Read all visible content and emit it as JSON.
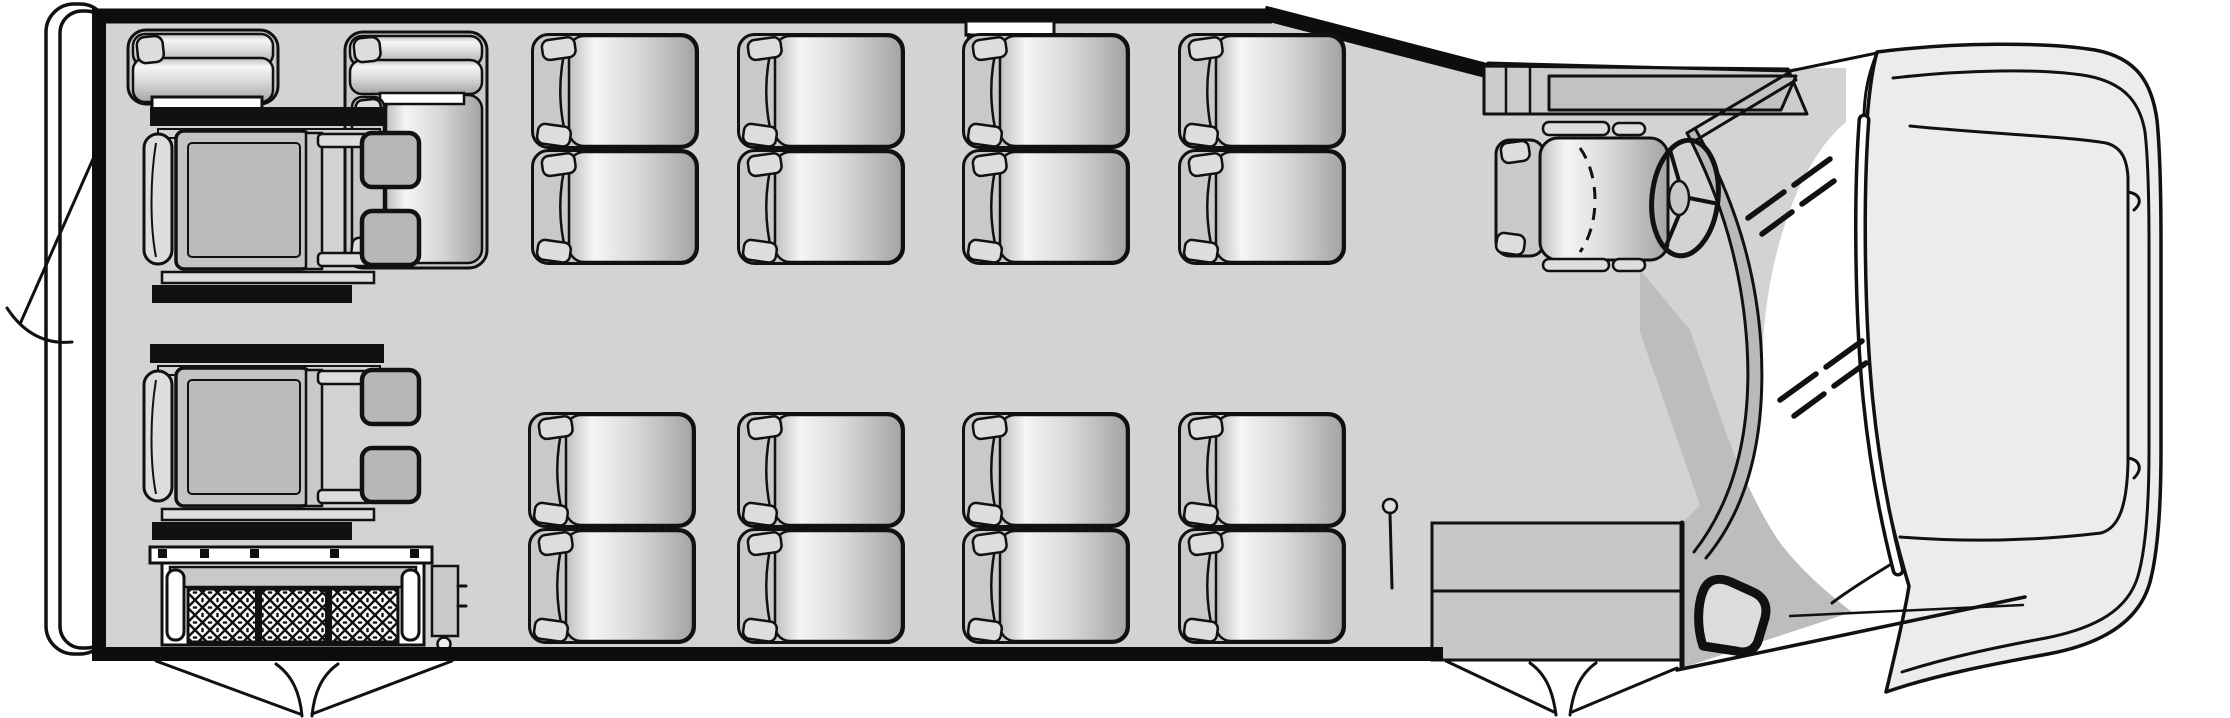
{
  "diagram": {
    "kind": "vehicle-floor-plan",
    "subject": "wheelchair-accessible-shuttle-bus-top-view",
    "vehicle_front_side": "right",
    "vehicle_rear_side": "left"
  },
  "counts": {
    "forward_facing_double_seat_blocks": 8,
    "forward_facing_passenger_seats": 16,
    "rear_flip_bench_seats": 2,
    "wheelchair_positions": 2,
    "wheelchair_securement_tracks": 4,
    "driver_seats": 1,
    "entry_steps": 2,
    "door_swing_marks": 3,
    "windshield_glass_marks": 2,
    "wheelchair_lifts": 1
  },
  "colors": {
    "background": "#ffffff",
    "floor": "#d3d3d3",
    "outline": "#111111",
    "wall": "#0d0d0d",
    "seat_frame": "#c9c9c9",
    "seat_cushion_light": "#f5f5f5",
    "seat_cushion_mid": "#d8d8d8",
    "seat_cushion_dark": "#a4a4a4",
    "strap": "#dddddd",
    "wheelchair_seat": "#c4c4c4",
    "wheelchair_seat_inner": "#bcbcbc",
    "footrest": "#b7b7b7",
    "steps": "#c7c7c7",
    "entry_panel": "#bdbdbd",
    "pillar": "#b9b9b9",
    "hood": "#ececec",
    "dash": "#cccccc",
    "dash_inner": "#c2c2c2",
    "lift_band": "#c9c9c9",
    "door_window": "#dcdcdc"
  },
  "layout": {
    "canvas": {
      "width": 2230,
      "height": 718
    },
    "seat_block_size": {
      "width": 168,
      "height": 232
    },
    "seat_blocks": [
      {
        "id": "curb-row-1",
        "x": 531,
        "y": 33
      },
      {
        "id": "curb-row-2",
        "x": 737,
        "y": 33
      },
      {
        "id": "curb-row-3",
        "x": 962,
        "y": 33
      },
      {
        "id": "curb-row-4",
        "x": 1178,
        "y": 33
      },
      {
        "id": "road-row-1",
        "x": 528,
        "y": 412
      },
      {
        "id": "road-row-2",
        "x": 737,
        "y": 412
      },
      {
        "id": "road-row-3",
        "x": 962,
        "y": 412
      },
      {
        "id": "road-row-4",
        "x": 1178,
        "y": 412
      }
    ],
    "wheelchair_positions": [
      {
        "id": "rear-upper",
        "x": 150,
        "y": 107
      },
      {
        "id": "rear-lower",
        "x": 150,
        "y": 344
      }
    ],
    "glass_marks": [
      {
        "id": "windshield-upper",
        "x": 1788,
        "y": 190
      },
      {
        "id": "windshield-lower",
        "x": 1820,
        "y": 372
      }
    ]
  }
}
